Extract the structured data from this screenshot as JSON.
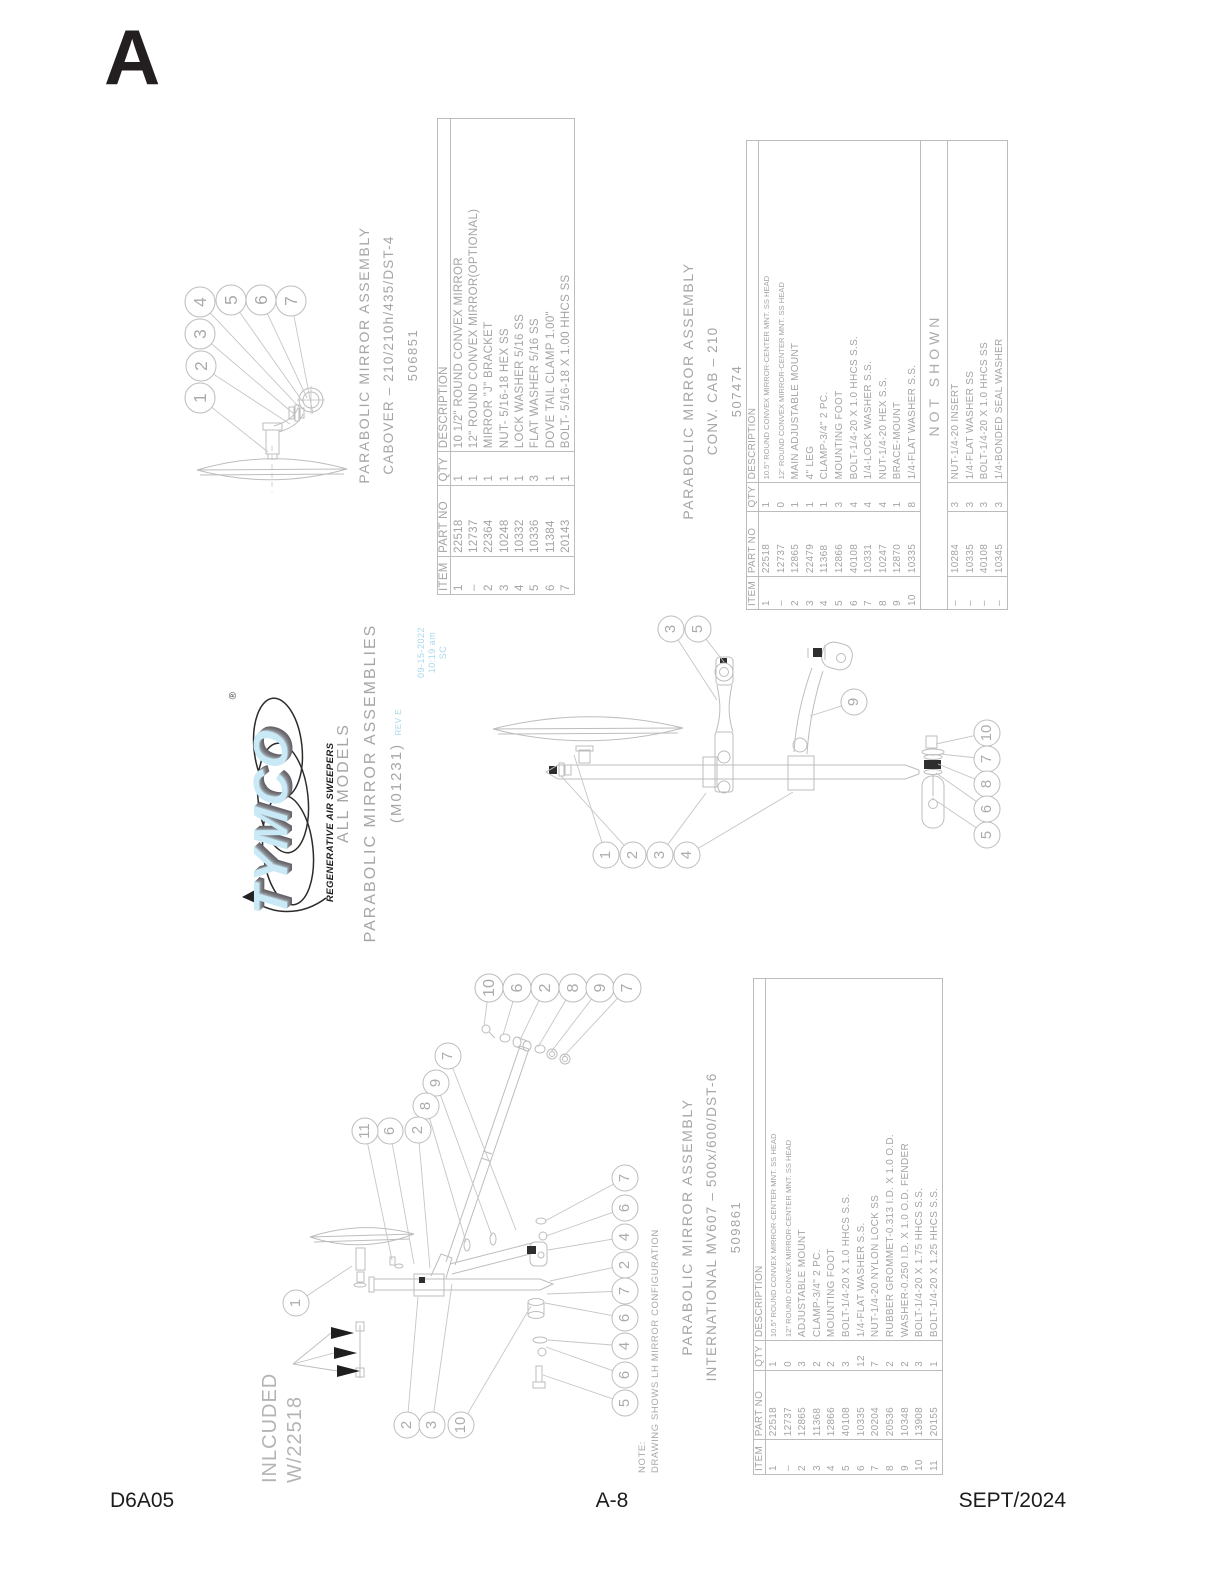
{
  "page": {
    "section_letter": "A",
    "footer": {
      "left": "D6A05",
      "center": "A-8",
      "right": "SEPT/2024"
    }
  },
  "colors": {
    "ink_black": "#231f20",
    "diagram_line": "#bdbdbd",
    "diagram_text": "#ababab",
    "stamp_blue": "#a9d8ec",
    "logo_blue": "#c9e9f7",
    "logo_shadow": "#6c6c72"
  },
  "logo": {
    "brand": "TYMCO",
    "registered": "®",
    "tagline": "REGENERATIVE AIR SWEEPERS"
  },
  "main_title": {
    "line1": "ALL MODELS",
    "line2": "PARABOLIC MIRROR ASSEMBLIES",
    "line3": "(M01231)",
    "rev": "REV E",
    "stamp_date": "09-15-2022",
    "stamp_time": "10:19 am",
    "stamp_initials": "SC"
  },
  "note": {
    "line1": "NOTE:",
    "line2": "DRAWING SHOWS LH MIRROR CONFIGURATION"
  },
  "included_note": {
    "line1": "INLCUDED",
    "line2": "W/22518"
  },
  "tables": [
    {
      "id": "cabover",
      "title_lines": [
        "PARABOLIC MIRROR ASSEMBLY",
        "CABOVER – 210/210h/435/DST-4",
        "506851"
      ],
      "headers": [
        "ITEM",
        "PART NO",
        "QTY",
        "DESCRIPTION"
      ],
      "col_widths": [
        8,
        15,
        7,
        70
      ],
      "rows": [
        [
          "1",
          "22518",
          "1",
          "10 1/2\" ROUND CONVEX MIRROR"
        ],
        [
          "–",
          "12737",
          "1",
          "12\" ROUND CONVEX MIRROR(OPTIONAL)"
        ],
        [
          "2",
          "22364",
          "1",
          "MIRROR \"J\" BRACKET"
        ],
        [
          "3",
          "10248",
          "1",
          "NUT- 5/16-18 HEX SS"
        ],
        [
          "4",
          "10332",
          "1",
          "LOCK WASHER 5/16 SS"
        ],
        [
          "5",
          "10336",
          "3",
          "FLAT WASHER 5/16 SS"
        ],
        [
          "6",
          "11384",
          "1",
          "DOVE TAIL CLAMP 1.00\""
        ],
        [
          "7",
          "20143",
          "1",
          "BOLT- 5/16-18 X 1.00 HHCS SS"
        ]
      ]
    },
    {
      "id": "convcab",
      "title_lines": [
        "PARABOLIC MIRROR ASSEMBLY",
        "CONV. CAB – 210",
        "507474"
      ],
      "headers": [
        "ITEM",
        "PART NO",
        "QTY",
        "DESCRIPTION"
      ],
      "col_widths": [
        7,
        14,
        6,
        73
      ],
      "rows": [
        [
          "1",
          "22518",
          "1",
          "10.5\" ROUND CONVEX MIRROR-CENTER MNT. SS HEAD"
        ],
        [
          "–",
          "12737",
          "0",
          "12\" ROUND CONVEX MIRROR-CENTER MNT. SS HEAD"
        ],
        [
          "2",
          "12865",
          "1",
          "MAIN ADJUSTABLE MOUNT"
        ],
        [
          "3",
          "22479",
          "1",
          "4\" LEG"
        ],
        [
          "4",
          "11368",
          "1",
          "CLAMP-3/4\" 2 PC."
        ],
        [
          "5",
          "12866",
          "3",
          "MOUNTING FOOT"
        ],
        [
          "6",
          "40108",
          "4",
          "BOLT-1/4-20 X 1.0 HHCS S.S."
        ],
        [
          "7",
          "10331",
          "4",
          "1/4-LOCK WASHER S.S."
        ],
        [
          "8",
          "10247",
          "4",
          "NUT-1/4-20 HEX S.S."
        ],
        [
          "9",
          "12870",
          "1",
          "BRACE-MOUNT"
        ],
        [
          "10",
          "10335",
          "8",
          "1/4-FLAT WASHER S.S."
        ]
      ],
      "not_shown_label": "NOT SHOWN",
      "not_shown_rows": [
        [
          "–",
          "10284",
          "3",
          "NUT-1/4-20 INSERT"
        ],
        [
          "–",
          "10335",
          "3",
          "1/4-FLAT WASHER SS"
        ],
        [
          "–",
          "40108",
          "3",
          "BOLT-1/4-20 X 1.0 HHCS SS"
        ],
        [
          "–",
          "10345",
          "3",
          "1/4-BONDED SEAL WASHER"
        ]
      ]
    },
    {
      "id": "international",
      "title_lines": [
        "PARABOLIC MIRROR ASSEMBLY",
        "INTERNATIONAL MV607 – 500x/600/DST-6",
        "509861"
      ],
      "headers": [
        "ITEM",
        "PART NO",
        "QTY",
        "DESCRIPTION"
      ],
      "col_widths": [
        7,
        14,
        6,
        73
      ],
      "rows": [
        [
          "1",
          "22518",
          "1",
          "10.5\" ROUND CONVEX MIRROR-CENTER MNT. SS HEAD"
        ],
        [
          "–",
          "12737",
          "0",
          "12\" ROUND CONVEX MIRROR-CENTER MNT. SS HEAD"
        ],
        [
          "2",
          "12865",
          "3",
          "ADJUSTABLE MOUNT"
        ],
        [
          "3",
          "11368",
          "2",
          "CLAMP-3/4\" 2 PC."
        ],
        [
          "4",
          "12866",
          "2",
          "MOUNTING FOOT"
        ],
        [
          "5",
          "40108",
          "3",
          "BOLT-1/4-20 X 1.0 HHCS S.S."
        ],
        [
          "6",
          "10335",
          "12",
          "1/4-FLAT WASHER S.S."
        ],
        [
          "7",
          "20204",
          "7",
          "NUT-1/4-20 NYLON LOCK SS"
        ],
        [
          "8",
          "20536",
          "2",
          "RUBBER GROMMET-0.313 I.D. X 1.0 O.D."
        ],
        [
          "9",
          "10348",
          "2",
          "WASHER-0.250 I.D. X 1.0 O.D. FENDER"
        ],
        [
          "10",
          "13908",
          "3",
          "BOLT-1/4-20 X 1.75 HHCS S.S."
        ],
        [
          "11",
          "20155",
          "1",
          "BOLT-1/4-20 X 1.25 HHCS S.S."
        ]
      ]
    }
  ],
  "diagrams": {
    "cabover": {
      "callout_radius": 15,
      "callouts": [
        {
          "n": "1",
          "x": 200,
          "y": 398,
          "tx": 268,
          "ty": 452
        },
        {
          "n": "2",
          "x": 201,
          "y": 366,
          "tx": 290,
          "ty": 424
        },
        {
          "n": "3",
          "x": 200,
          "y": 334,
          "tx": 294,
          "ty": 414
        },
        {
          "n": "4",
          "x": 200,
          "y": 302,
          "tx": 299,
          "ty": 407
        },
        {
          "n": "5",
          "x": 231,
          "y": 300,
          "tx": 303,
          "ty": 402
        },
        {
          "n": "6",
          "x": 261,
          "y": 300,
          "tx": 307,
          "ty": 398
        },
        {
          "n": "7",
          "x": 291,
          "y": 301,
          "tx": 313,
          "ty": 414
        }
      ]
    },
    "convcab": {
      "callout_radius": 13,
      "callouts": [
        {
          "n": "3",
          "x": 671,
          "y": 629,
          "tx": 717,
          "ty": 700
        },
        {
          "n": "5",
          "x": 698,
          "y": 629,
          "tx": 724,
          "ty": 662
        },
        {
          "n": "9",
          "x": 854,
          "y": 702,
          "tx": 810,
          "ty": 716
        },
        {
          "n": "10",
          "x": 987,
          "y": 733,
          "tx": 936,
          "ty": 744
        },
        {
          "n": "7",
          "x": 987,
          "y": 759,
          "tx": 940,
          "ty": 754
        },
        {
          "n": "8",
          "x": 987,
          "y": 784,
          "tx": 938,
          "ty": 764
        },
        {
          "n": "6",
          "x": 987,
          "y": 809,
          "tx": 936,
          "ty": 773
        },
        {
          "n": "5",
          "x": 987,
          "y": 835,
          "tx": 932,
          "ty": 798
        },
        {
          "n": "1",
          "x": 606,
          "y": 855,
          "tx": 574,
          "ty": 755
        },
        {
          "n": "2",
          "x": 633,
          "y": 855,
          "tx": 561,
          "ty": 776
        },
        {
          "n": "3",
          "x": 660,
          "y": 855,
          "tx": 706,
          "ty": 793
        },
        {
          "n": "4",
          "x": 687,
          "y": 855,
          "tx": 793,
          "ty": 792
        }
      ]
    },
    "international": {
      "callout_radius": 13,
      "callouts": [
        {
          "n": "10",
          "x": 489,
          "y": 988,
          "r": 14,
          "tx": 484,
          "ty": 1026
        },
        {
          "n": "6",
          "x": 517,
          "y": 988,
          "r": 14,
          "tx": 503,
          "ty": 1035
        },
        {
          "n": "2",
          "x": 545,
          "y": 988,
          "r": 14,
          "tx": 520,
          "ty": 1040
        },
        {
          "n": "8",
          "x": 573,
          "y": 988,
          "r": 14,
          "tx": 538,
          "ty": 1047
        },
        {
          "n": "9",
          "x": 600,
          "y": 988,
          "r": 14,
          "tx": 551,
          "ty": 1052
        },
        {
          "n": "7",
          "x": 627,
          "y": 988,
          "r": 14,
          "tx": 563,
          "ty": 1057
        },
        {
          "n": "7",
          "x": 448,
          "y": 1056,
          "tx": 516,
          "ty": 1230
        },
        {
          "n": "9",
          "x": 436,
          "y": 1083,
          "tx": 492,
          "ty": 1236
        },
        {
          "n": "8",
          "x": 426,
          "y": 1106,
          "tx": 466,
          "ty": 1242
        },
        {
          "n": "2",
          "x": 418,
          "y": 1130,
          "tx": 430,
          "ty": 1268
        },
        {
          "n": "6",
          "x": 390,
          "y": 1131,
          "tx": 414,
          "ty": 1264
        },
        {
          "n": "11",
          "x": 365,
          "y": 1131,
          "tx": 392,
          "ty": 1260
        },
        {
          "n": "1",
          "x": 296,
          "y": 1303,
          "tx": 352,
          "ty": 1266
        },
        {
          "n": "7",
          "x": 625,
          "y": 1178,
          "tx": 545,
          "ty": 1221
        },
        {
          "n": "6",
          "x": 625,
          "y": 1208,
          "tx": 546,
          "ty": 1236
        },
        {
          "n": "4",
          "x": 625,
          "y": 1237,
          "tx": 548,
          "ty": 1250
        },
        {
          "n": "2",
          "x": 625,
          "y": 1265,
          "tx": 550,
          "ty": 1281
        },
        {
          "n": "7",
          "x": 625,
          "y": 1291,
          "tx": 547,
          "ty": 1294
        },
        {
          "n": "6",
          "x": 625,
          "y": 1318,
          "tx": 545,
          "ty": 1303
        },
        {
          "n": "4",
          "x": 625,
          "y": 1346,
          "tx": 548,
          "ty": 1340
        },
        {
          "n": "6",
          "x": 625,
          "y": 1375,
          "tx": 546,
          "ty": 1347
        },
        {
          "n": "5",
          "x": 625,
          "y": 1403,
          "tx": 543,
          "ty": 1375
        },
        {
          "n": "2",
          "x": 407,
          "y": 1425,
          "tx": 418,
          "ty": 1297
        },
        {
          "n": "3",
          "x": 432,
          "y": 1425,
          "tx": 452,
          "ty": 1284
        },
        {
          "n": "10",
          "x": 461,
          "y": 1425,
          "tx": 531,
          "ty": 1306
        }
      ]
    }
  }
}
